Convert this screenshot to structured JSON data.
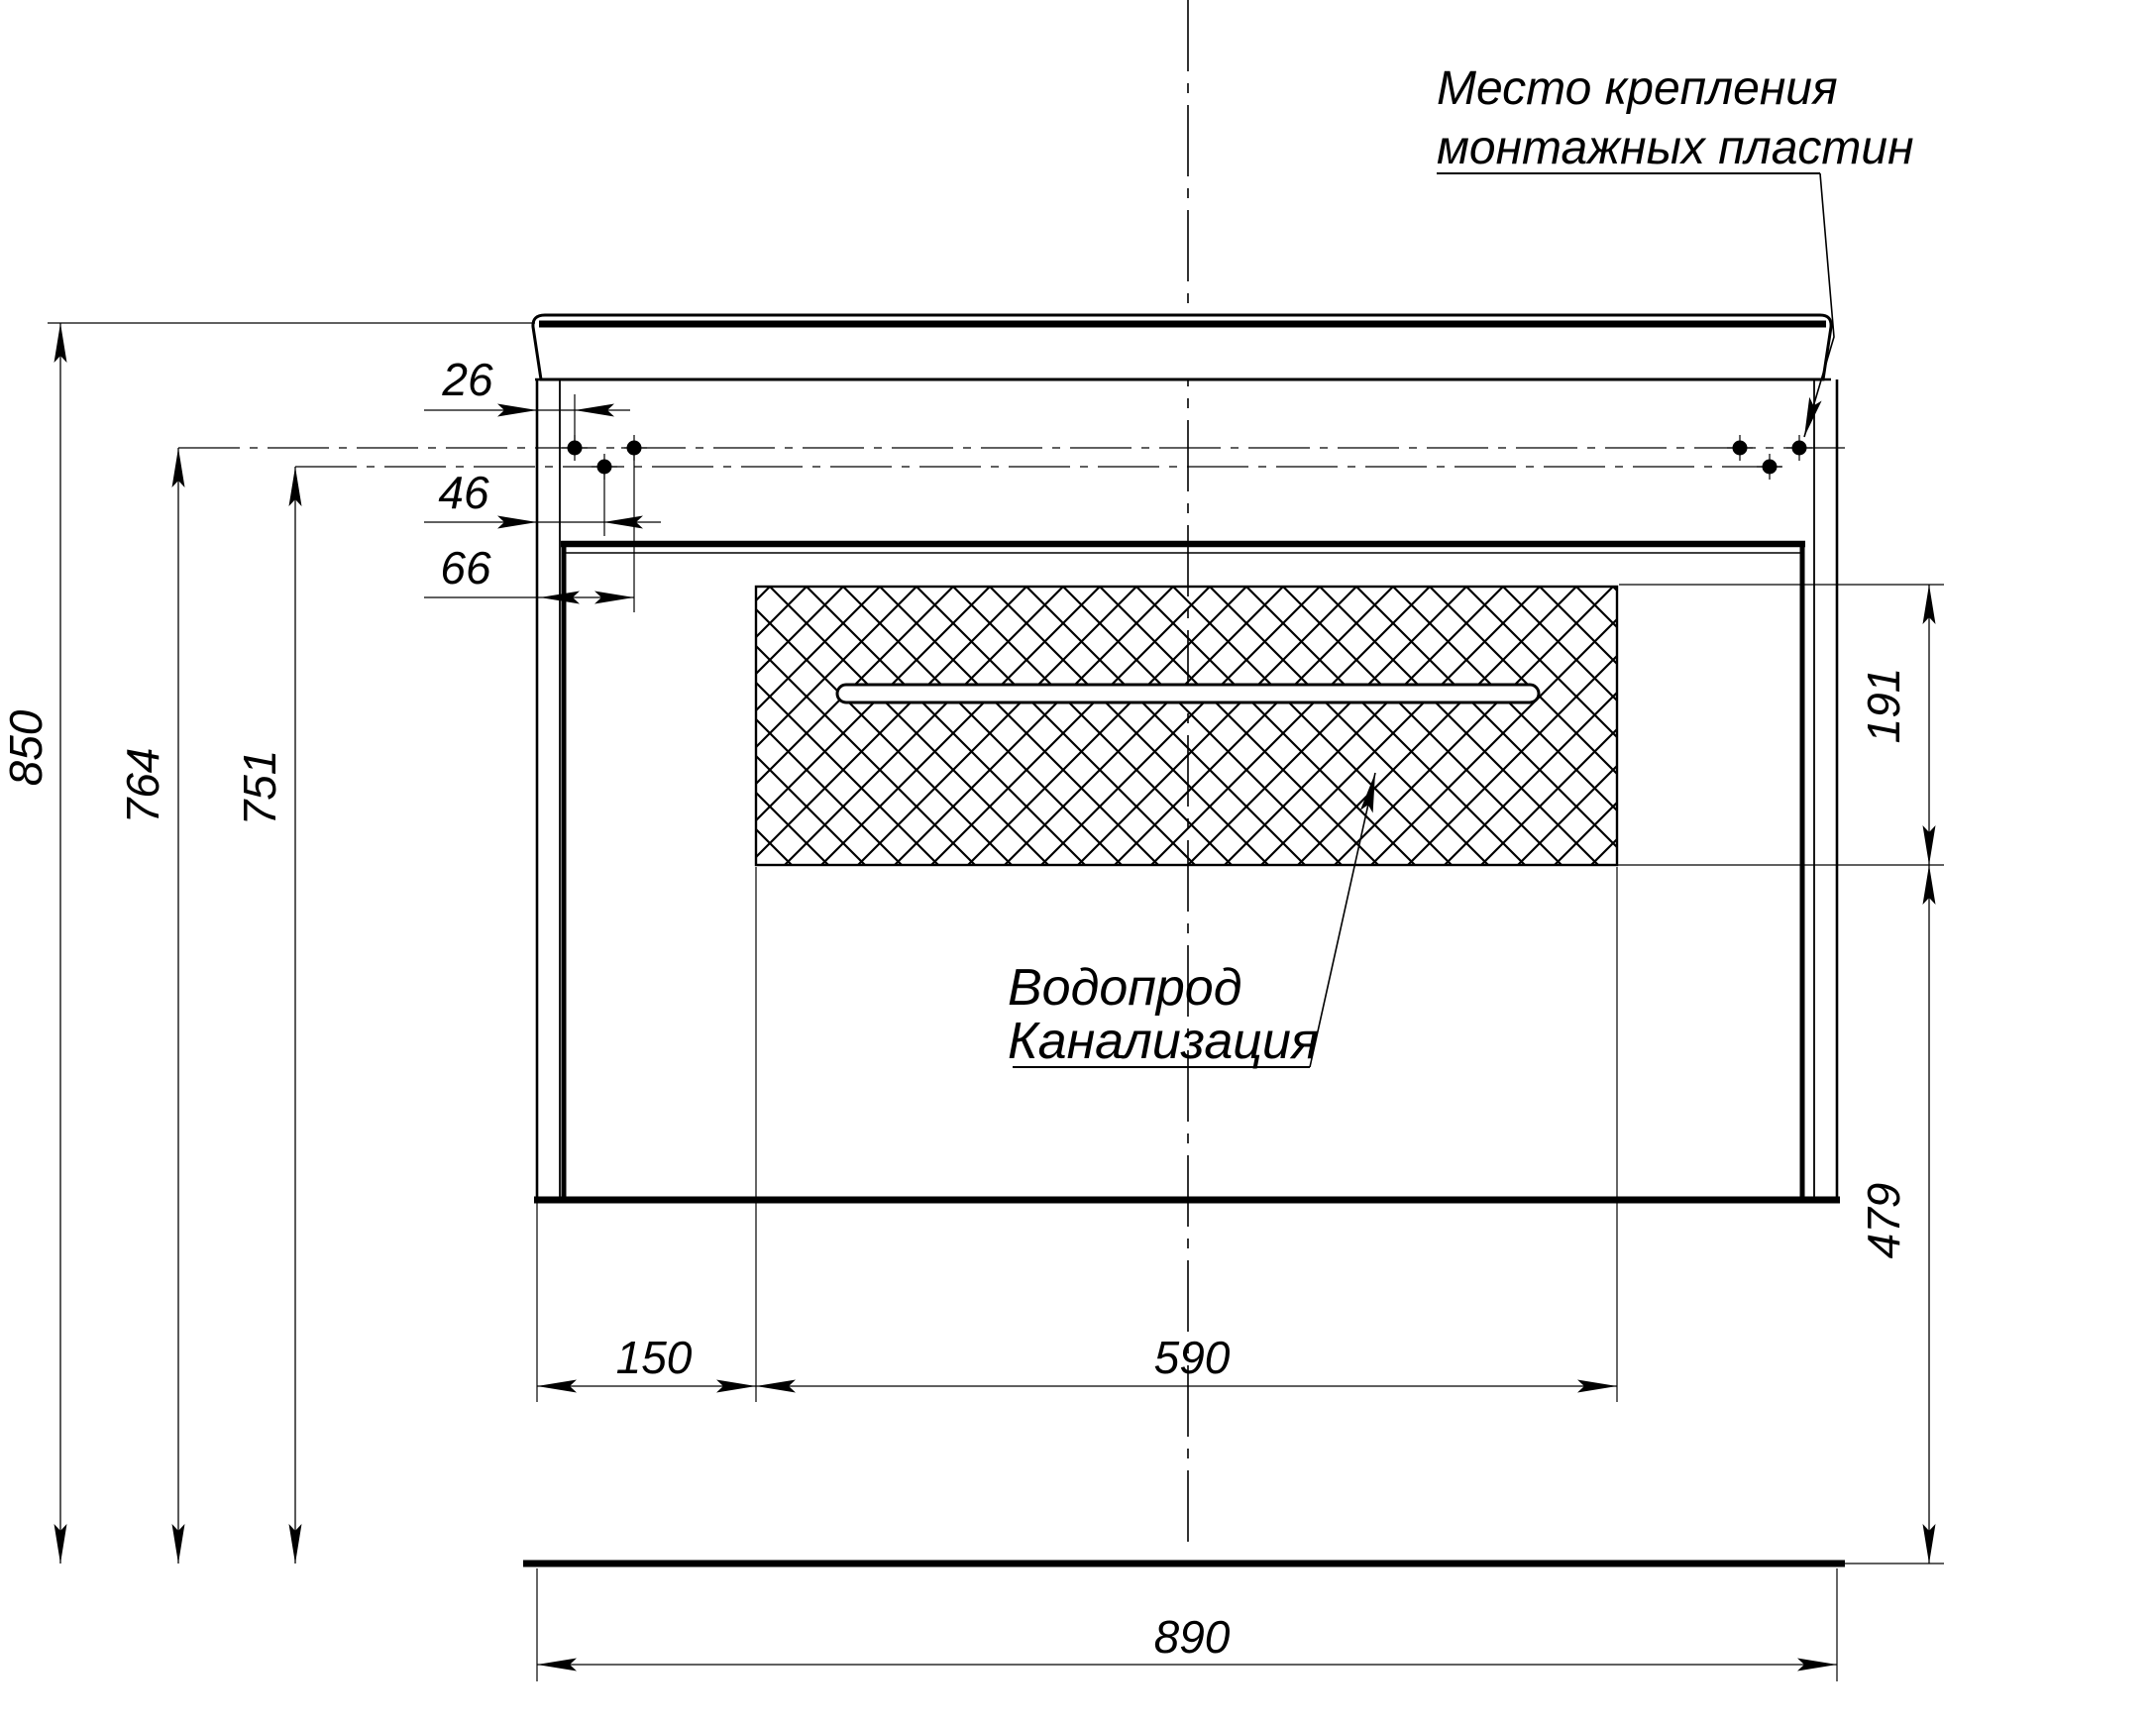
{
  "title": "Vanity cabinet installation drawing",
  "annotations": {
    "mounting_label_line1": "Место крепления",
    "mounting_label_line2": "монтажных пластин",
    "plumbing_label_line1": "Водопрод",
    "plumbing_label_line2": "Канализация"
  },
  "dimensions": {
    "hole_offset_1": "26",
    "hole_offset_2": "46",
    "hole_offset_3": "66",
    "total_height": "850",
    "upper_holes_height": "764",
    "lower_holes_height": "751",
    "hatch_zone_height": "191",
    "clearance_below": "479",
    "hatch_left_offset": "150",
    "hatch_zone_width": "590",
    "cabinet_width": "890"
  },
  "colors": {
    "line": "#000000",
    "background": "#ffffff"
  }
}
